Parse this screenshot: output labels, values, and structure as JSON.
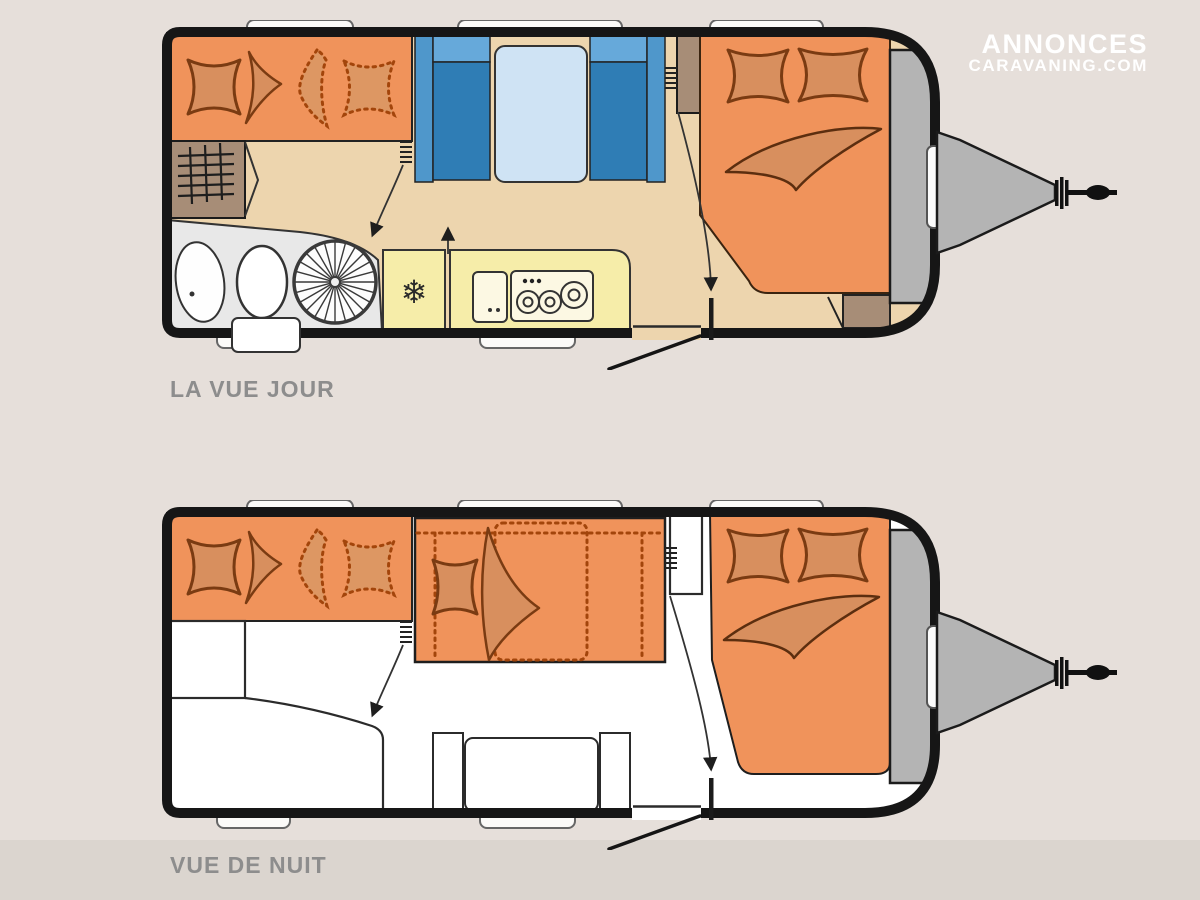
{
  "page": {
    "background": "#E6DFDA",
    "footer_band": "#DBD5CF"
  },
  "logo": {
    "line1": "ANNONCES",
    "line2": "CARAVANING.COM",
    "color": "#FFFFFF"
  },
  "views": {
    "day": {
      "label": "LA VUE JOUR"
    },
    "night": {
      "label": "VUE DE NUIT"
    }
  },
  "icons": {
    "snowflake": "❄"
  },
  "colors": {
    "wall": "#161616",
    "upholstery_orange": "#F0935B",
    "cushion_orange": "#D88F5E",
    "cushion_outline": "#7A3B12",
    "dotted_stitch": "#A3450B",
    "floor_tan": "#EDD5AE",
    "kitchen_yellow": "#F6EDA9",
    "appliance_cream": "#FCF8E3",
    "seat_blue_dark": "#2F7DB5",
    "seat_blue_light": "#66A9DA",
    "seat_blue_mid": "#4F97CB",
    "table_blue": "#CFE3F4",
    "cabinet_brown": "#A78D77",
    "bathroom_grey": "#E8E8E8",
    "hitch_grey": "#B4B4B4",
    "window_white": "#FBFAF8",
    "label_grey": "#8D8D8D"
  }
}
